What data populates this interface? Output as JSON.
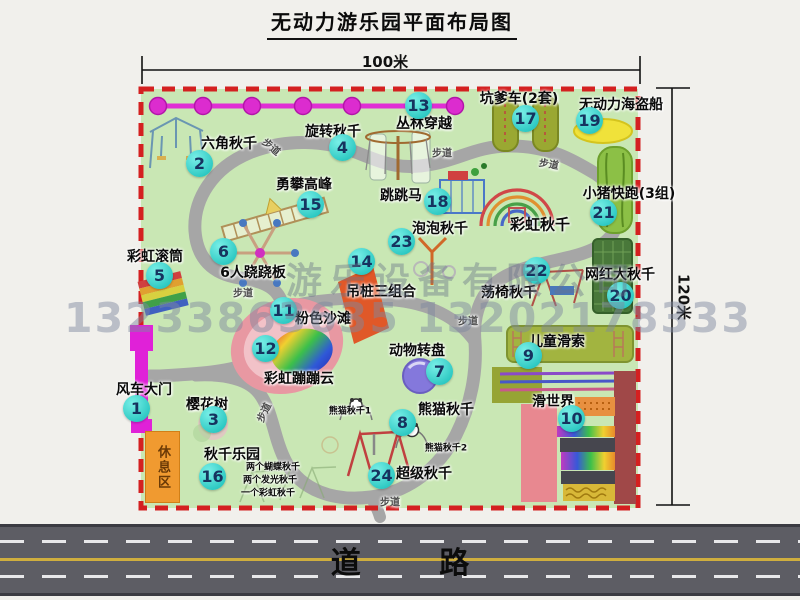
{
  "title": "无动力游乐园平面布局图",
  "dim_top": "100米",
  "dim_right": "120米",
  "road_label": "道 路",
  "rest_area": "休息区",
  "watermark": {
    "company": "游乐设备有限公司",
    "phones": "13233863635 13202178333"
  },
  "colors": {
    "park_green": "#c9e7b4",
    "border_red": "#d42020",
    "badge_teal": "#2cc8c2",
    "gate_magenta": "#e021d8",
    "jungle_magenta": "#e02fd4",
    "rest_orange": "#f09a30",
    "road_gray": "#5d5d64",
    "path_gray": "#a6a6a6",
    "pirate_yellow": "#f0e23a"
  },
  "map_symbols": [
    "windmill-gate",
    "jungle-crossing-line",
    "hex-swing-frame",
    "rotating-swing",
    "climbing-ladder",
    "jumping-horse-frame",
    "rainbow-swing-arcs",
    "rainbow-roller",
    "six-seesaw-star",
    "bubble-swing-pole",
    "hanging-pile-pad",
    "pink-beach-pond",
    "rainbow-cloud-blob",
    "animal-turntable-disc",
    "panda-swing-frames",
    "super-swing-frame",
    "swing-chair-frame",
    "net-swing-box",
    "pit-car-tracks",
    "piggy-run-track",
    "pirate-ship-boat",
    "zipline-platform",
    "slide-world-lanes",
    "cherry-tree",
    "walkways"
  ],
  "attractions": [
    {
      "num": "1",
      "label": "风车大门",
      "bx": 137,
      "by": 409,
      "lx": 144,
      "ly": 389
    },
    {
      "num": "2",
      "label": "六角秋千",
      "bx": 200,
      "by": 164,
      "lx": 229,
      "ly": 143
    },
    {
      "num": "3",
      "label": "樱花树",
      "bx": 214,
      "by": 420,
      "lx": 207,
      "ly": 404
    },
    {
      "num": "4",
      "label": "旋转秋千",
      "bx": 343,
      "by": 148,
      "lx": 333,
      "ly": 131
    },
    {
      "num": "5",
      "label": "彩虹滚筒",
      "bx": 160,
      "by": 276,
      "lx": 155,
      "ly": 256
    },
    {
      "num": "6",
      "label": "6人跷跷板",
      "bx": 224,
      "by": 252,
      "lx": 253,
      "ly": 272
    },
    {
      "num": "7",
      "label": "动物转盘",
      "bx": 440,
      "by": 372,
      "lx": 417,
      "ly": 350
    },
    {
      "num": "8",
      "label": "熊猫秋千",
      "bx": 403,
      "by": 423,
      "lx": 446,
      "ly": 409
    },
    {
      "num": "9",
      "label": "儿童滑索",
      "bx": 529,
      "by": 356,
      "lx": 557,
      "ly": 341
    },
    {
      "num": "10",
      "label": "滑世界",
      "bx": 572,
      "by": 419,
      "lx": 553,
      "ly": 401
    },
    {
      "num": "11",
      "label": "粉色沙滩",
      "bx": 284,
      "by": 311,
      "lx": 323,
      "ly": 318
    },
    {
      "num": "12",
      "label": "彩虹蹦蹦云",
      "bx": 266,
      "by": 349,
      "lx": 299,
      "ly": 378
    },
    {
      "num": "13",
      "label": "丛林穿越",
      "bx": 419,
      "by": 106,
      "lx": 424,
      "ly": 123
    },
    {
      "num": "14",
      "label": "吊桩三组合",
      "bx": 362,
      "by": 262,
      "lx": 381,
      "ly": 291
    },
    {
      "num": "15",
      "label": "勇攀高峰",
      "bx": 311,
      "by": 205,
      "lx": 304,
      "ly": 184
    },
    {
      "num": "16",
      "label": "秋千乐园",
      "bx": 213,
      "by": 477,
      "lx": 232,
      "ly": 454
    },
    {
      "num": "17",
      "label": "坑爹车(2套)",
      "bx": 526,
      "by": 119,
      "lx": 519,
      "ly": 98
    },
    {
      "num": "18",
      "label": "跳跳马",
      "bx": 438,
      "by": 202,
      "lx": 401,
      "ly": 195
    },
    {
      "num": "19",
      "label": "无动力海盗船",
      "bx": 590,
      "by": 121,
      "lx": 621,
      "ly": 104
    },
    {
      "num": "20",
      "label": "网红大秋千",
      "bx": 621,
      "by": 296,
      "lx": 620,
      "ly": 274
    },
    {
      "num": "21",
      "label": "小猪快跑(3组)",
      "bx": 604,
      "by": 213,
      "lx": 629,
      "ly": 193
    },
    {
      "num": "22",
      "label": "荡椅秋千",
      "bx": 537,
      "by": 271,
      "lx": 509,
      "ly": 292
    },
    {
      "num": "23",
      "label": "泡泡秋千",
      "bx": 402,
      "by": 242,
      "lx": 440,
      "ly": 228
    },
    {
      "num": "24",
      "label": "超级秋千",
      "bx": 382,
      "by": 476,
      "lx": 424,
      "ly": 473
    }
  ],
  "extra_labels": [
    {
      "t": "彩虹秋千",
      "x": 540,
      "y": 224,
      "s": 15
    },
    {
      "t": "熊猫秋千1",
      "x": 350,
      "y": 410,
      "s": 9
    },
    {
      "t": "熊猫秋千2",
      "x": 446,
      "y": 447,
      "s": 9
    },
    {
      "t": "两个蝴蝶秋千",
      "x": 273,
      "y": 466,
      "s": 9
    },
    {
      "t": "两个发光秋千",
      "x": 270,
      "y": 479,
      "s": 9
    },
    {
      "t": "一个彩虹秋千",
      "x": 268,
      "y": 492,
      "s": 9
    },
    {
      "t": "步道",
      "x": 272,
      "y": 146,
      "s": 10,
      "r": 40,
      "c": "#4a4a4a"
    },
    {
      "t": "步道",
      "x": 442,
      "y": 152,
      "s": 10,
      "c": "#4a4a4a"
    },
    {
      "t": "步道",
      "x": 549,
      "y": 163,
      "s": 10,
      "r": 10,
      "c": "#4a4a4a"
    },
    {
      "t": "步道",
      "x": 243,
      "y": 292,
      "s": 10,
      "c": "#4a4a4a"
    },
    {
      "t": "步道",
      "x": 468,
      "y": 320,
      "s": 10,
      "c": "#4a4a4a"
    },
    {
      "t": "步道",
      "x": 390,
      "y": 501,
      "s": 10,
      "c": "#4a4a4a"
    },
    {
      "t": "步道",
      "x": 263,
      "y": 412,
      "s": 10,
      "r": -65,
      "c": "#4a4a4a"
    }
  ]
}
